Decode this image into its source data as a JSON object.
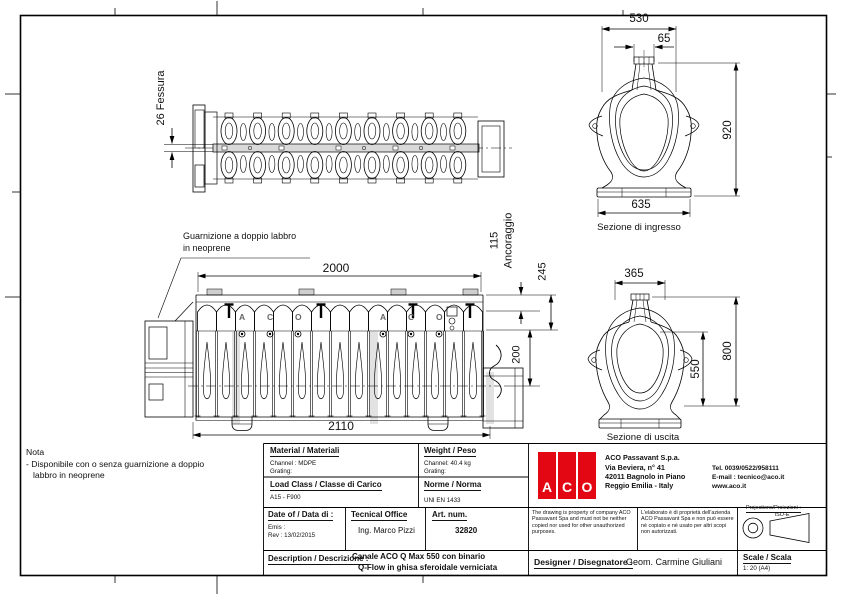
{
  "views": {
    "plan": {
      "slot_label": "26 Fessura"
    },
    "side": {
      "note_line1": "Guarnizione a doppio labbro",
      "note_line2": "in neoprene",
      "dim_top": "2000",
      "dim_bottom": "2110",
      "dim_anchor_value": "115",
      "dim_anchor_label": "Ancoraggio",
      "dim_245": "245",
      "dim_200": "200",
      "brand_letters": [
        "A",
        "C",
        "O",
        "A",
        "C",
        "O"
      ]
    },
    "inlet": {
      "caption": "Sezione di ingresso",
      "dim_width_top": "530",
      "dim_slot": "65",
      "dim_height": "920",
      "dim_width_bottom": "635"
    },
    "outlet": {
      "caption": "Sezione di uscita",
      "dim_width_top": "365",
      "dim_height_total": "800",
      "dim_height_inner": "550"
    }
  },
  "note": {
    "title": "Nota",
    "line1": "- Disponibile con o senza guarnizione a doppio",
    "line2": "labbro in neoprene"
  },
  "titleblock": {
    "material": {
      "label": "Material / Materiali",
      "channel": "Channel : MDPE",
      "grating": "Grating:"
    },
    "weight": {
      "label": "Weight / Peso",
      "channel": "Channel: 40.4 kg",
      "grating": "Grating:"
    },
    "load_class": {
      "label": "Load Class / Classe di Carico",
      "value": "A15 - F900"
    },
    "norm": {
      "label": "Norme / Norma",
      "value": "UNI EN 1433"
    },
    "date": {
      "label": "Date of / Data di :",
      "emis": "Emis :",
      "rev": "Rev : 13/02/2015"
    },
    "office": {
      "label": "Tecnical Office",
      "value": "Ing. Marco Pizzi"
    },
    "artnum": {
      "label": "Art. num.",
      "value": "32820"
    },
    "description": {
      "label": "Description / Descrizione :",
      "line1": "Canale ACO Q Max 550 con binario",
      "line2": "Q-Flow in ghisa sferoidale verniciata"
    },
    "company": {
      "logo_letters": [
        "A",
        "C",
        "O"
      ],
      "logo_color": "#e30613",
      "name": "ACO Passavant S.p.a.",
      "address1": "Via Beviera, n° 41",
      "address2": "42011 Bagnolo in Piano",
      "address3": "Reggio Emilia - Italy",
      "tel": "Tel. 0039/0522/958111",
      "email": "E-mail : tecnico@aco.it",
      "web": "www.aco.it"
    },
    "copyright_en": "The drawing is property of company ACO Passavant Spa and must not be neither copied nor used for other unauthorized purposes.",
    "copyright_it": "L'elaborato è di proprietà dell'azienda ACO Passavant Spa e non può essere nè copiato e nè usato per altri scopi non autorizzati.",
    "projections": {
      "label": "Projections/Proiezioni :",
      "value": "ISO-E"
    },
    "designer": {
      "label": "Designer / Disegnatore :",
      "value": "Geom. Carmine Giuliani"
    },
    "scale": {
      "label": "Scale / Scala",
      "value": "1: 20  (A4)"
    }
  }
}
